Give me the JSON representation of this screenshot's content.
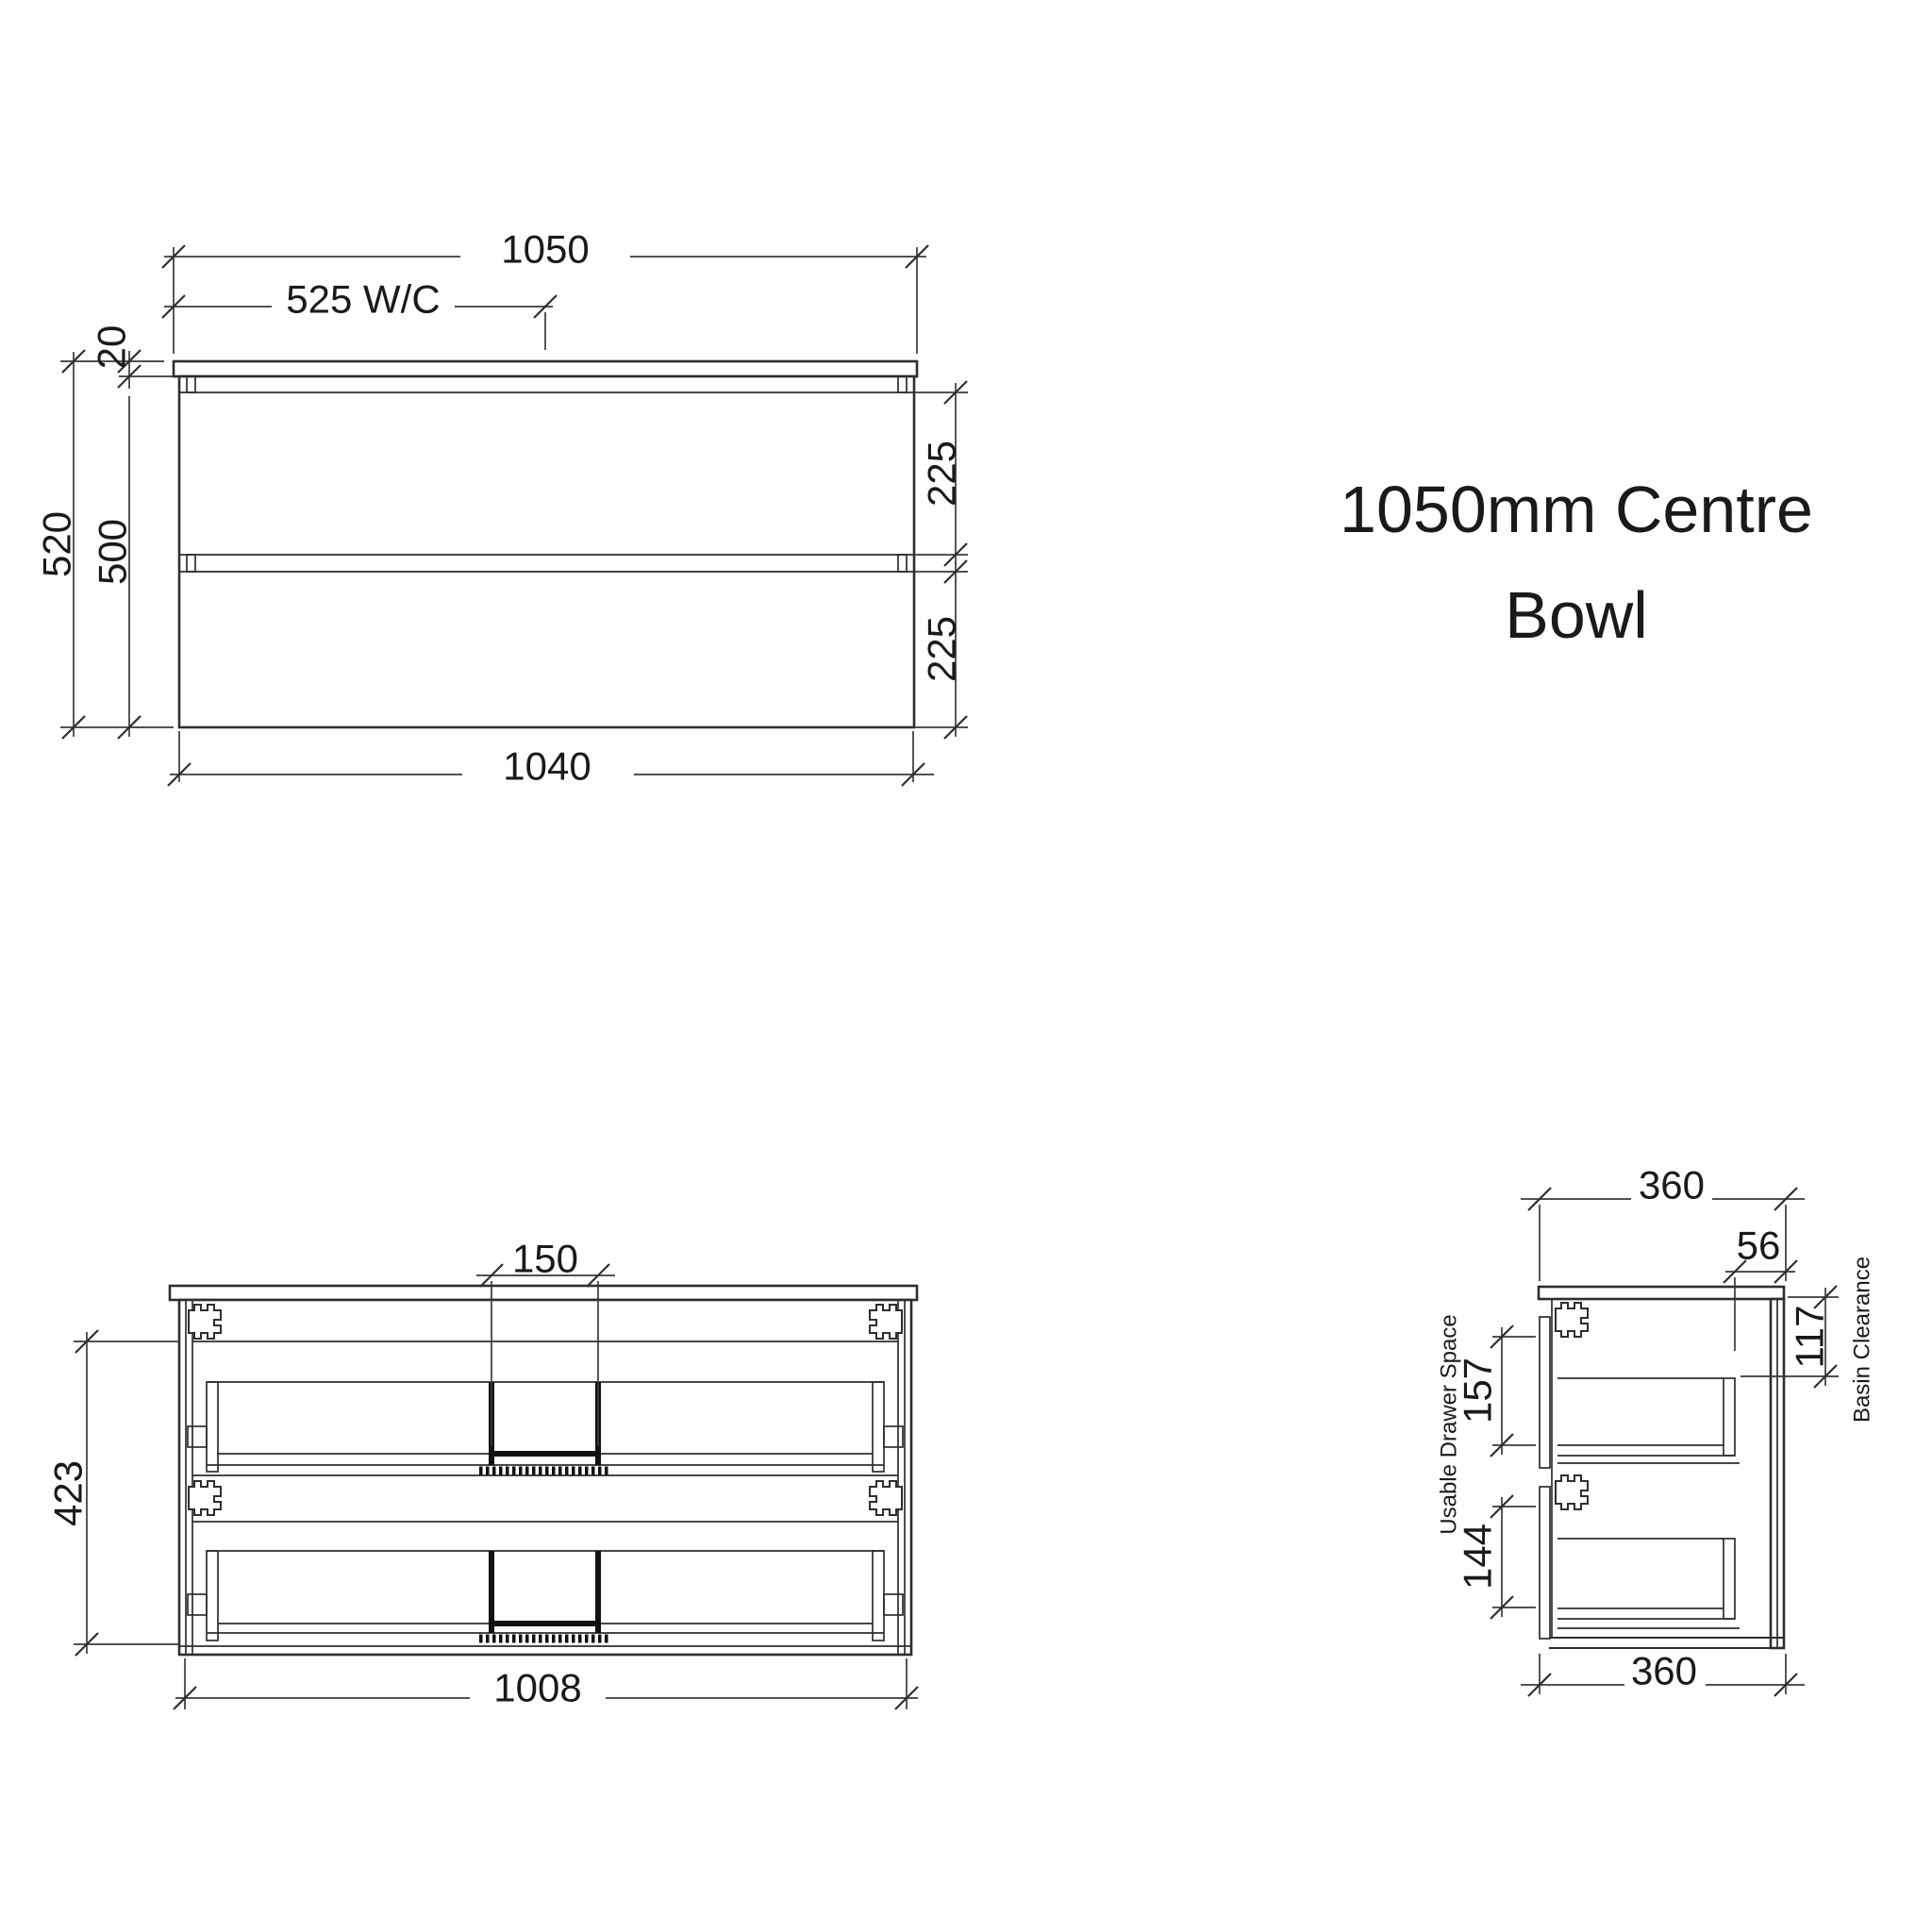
{
  "title": {
    "line1": "1050mm Centre",
    "line2": "Bowl"
  },
  "colors": {
    "background": "#ffffff",
    "line": "#2e2e2e",
    "text": "#1a1a1a",
    "bold_line": "#111111"
  },
  "views": {
    "front": {
      "dims": {
        "overall_width": "1050",
        "centre_wc": "525 W/C",
        "top_thickness": "20",
        "overall_height": "520",
        "cabinet_height": "500",
        "top_drawer": "225",
        "bottom_drawer": "225",
        "cabinet_width": "1040"
      }
    },
    "internal": {
      "dims": {
        "cutout_width": "150",
        "internal_height": "423",
        "internal_width": "1008"
      }
    },
    "side": {
      "dims": {
        "depth_top": "360",
        "back_clearance": "56",
        "basin_clearance": "117",
        "drawer_space_top": "157",
        "drawer_space_bottom": "144",
        "depth_bottom": "360"
      },
      "labels": {
        "basin_clearance": "Basin Clearance",
        "usable_drawer_space": "Usable Drawer Space"
      }
    }
  }
}
